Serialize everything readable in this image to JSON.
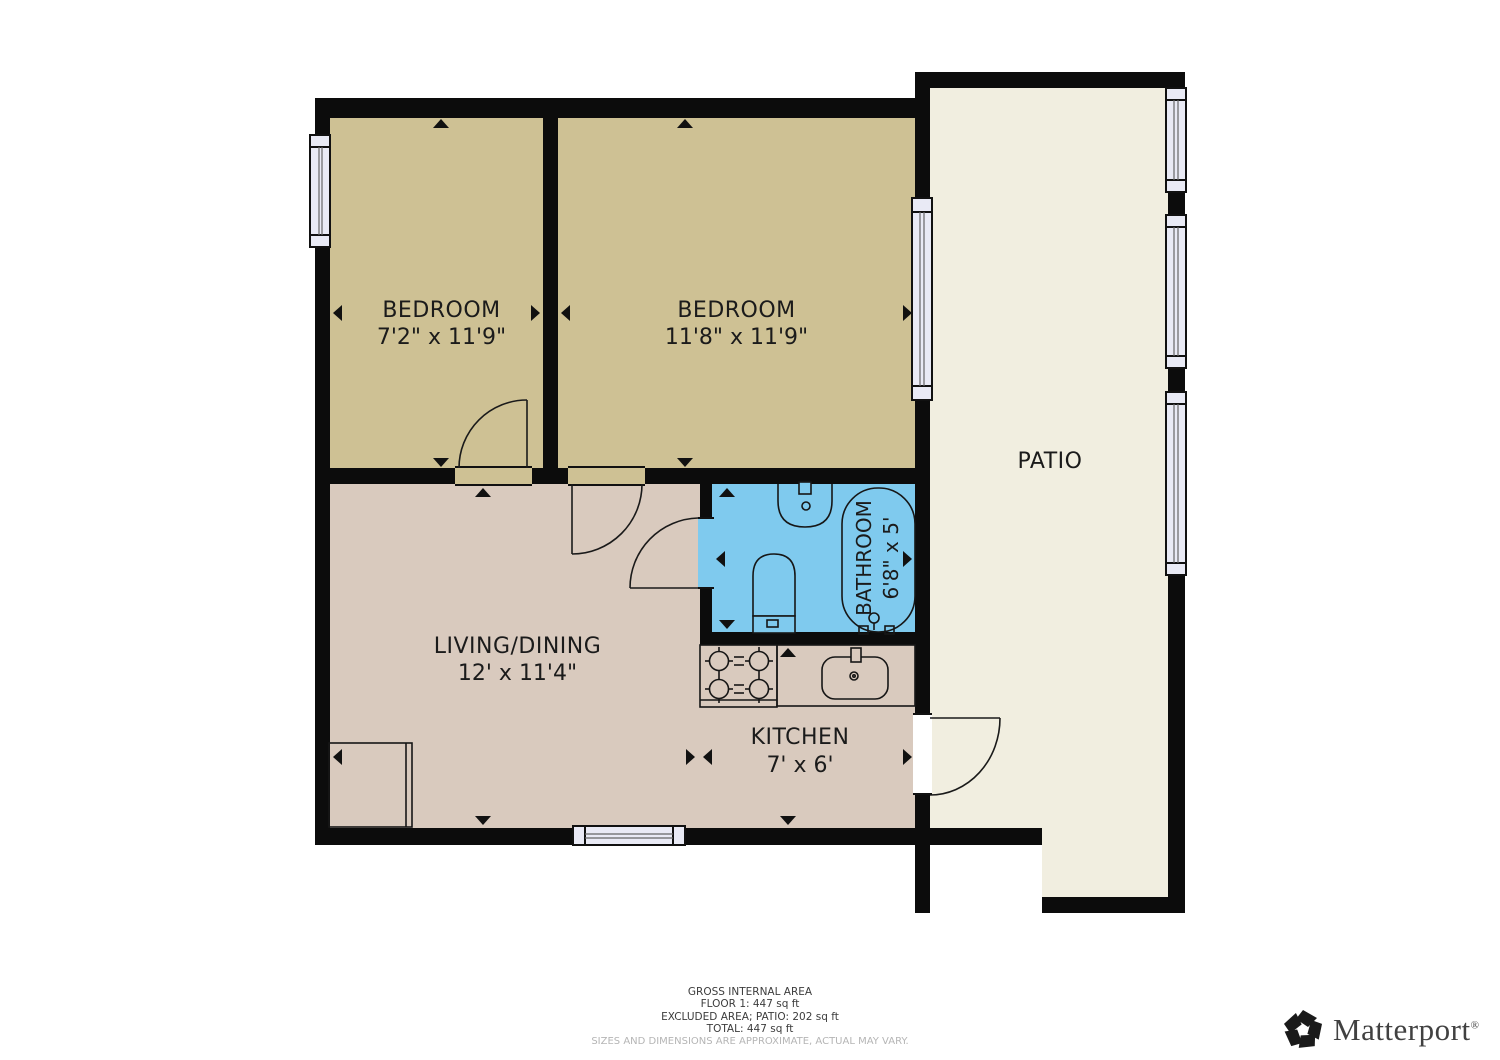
{
  "colors": {
    "wall": "#0c0c0c",
    "bedroom_floor": "#cec194",
    "living_floor": "#d9cabe",
    "bathroom_floor": "#7fcaee",
    "patio_floor": "#f1eee0",
    "window_fill": "#e9eaf5",
    "label_text": "#1b1b1b",
    "footer_text": "#3c3c3c",
    "disclaimer_text": "#b5b5b5",
    "logo_text": "#414141"
  },
  "rooms": {
    "bedroom1": {
      "name": "BEDROOM",
      "dims": "7'2\" x 11'9\""
    },
    "bedroom2": {
      "name": "BEDROOM",
      "dims": "11'8\" x 11'9\""
    },
    "living": {
      "name": "LIVING/DINING",
      "dims": "12' x 11'4\""
    },
    "kitchen": {
      "name": "KITCHEN",
      "dims": "7' x 6'"
    },
    "bathroom": {
      "name": "BATHROOM",
      "dims": "6'8\" x 5'"
    },
    "patio": {
      "name": "PATIO"
    }
  },
  "footer": {
    "line1": "GROSS INTERNAL AREA",
    "line2": "FLOOR 1: 447 sq ft",
    "line3": "EXCLUDED AREA; PATIO: 202 sq ft",
    "line4": "TOTAL: 447 sq ft",
    "disclaimer": "SIZES AND DIMENSIONS ARE APPROXIMATE, ACTUAL MAY VARY."
  },
  "branding": {
    "logo_text": "Matterport",
    "registered": "®"
  }
}
